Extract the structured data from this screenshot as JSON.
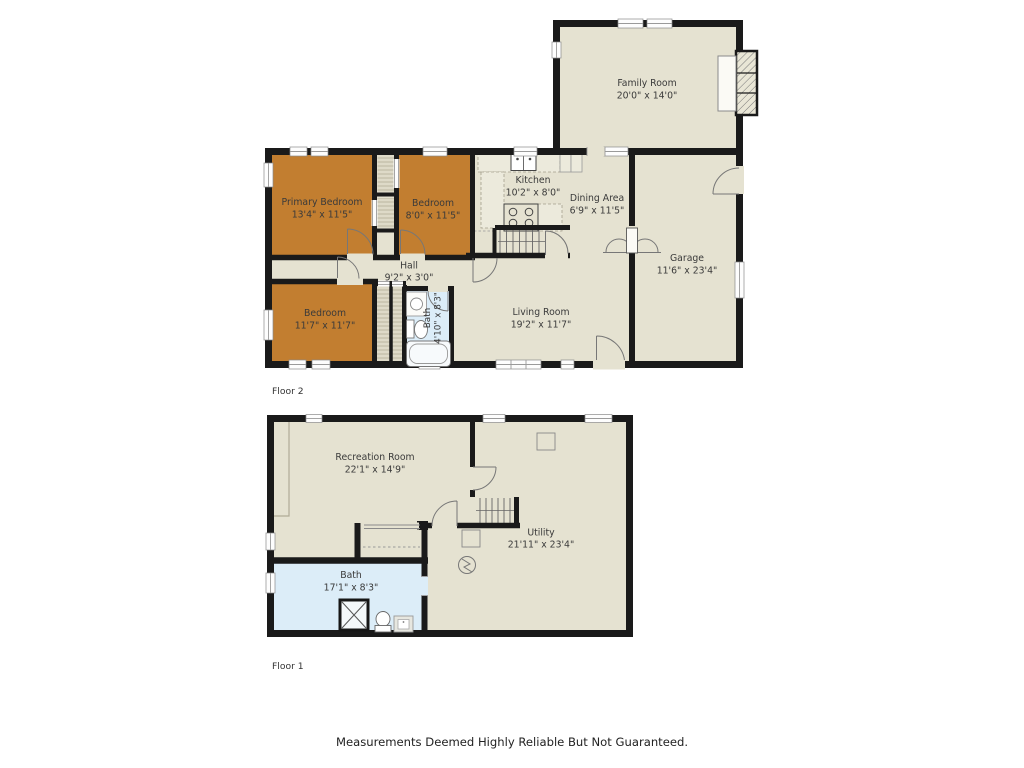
{
  "page": {
    "disclaimer": "Measurements Deemed Highly Reliable But Not Guaranteed."
  },
  "colors": {
    "floor_fill": "#E5E2D1",
    "bedroom_accent": "#C27E30",
    "bath_fill": "#DCEDF8",
    "wall": "#1A1A1A",
    "label_text": "#3A3A3A"
  },
  "floor2": {
    "label": "Floor 2",
    "rooms": {
      "family_room": {
        "name": "Family Room",
        "dims": "20'0\" x 14'0\""
      },
      "kitchen": {
        "name": "Kitchen",
        "dims": "10'2\" x 8'0\""
      },
      "dining": {
        "name": "Dining Area",
        "dims": "6'9\" x 11'5\""
      },
      "primary_bedroom": {
        "name": "Primary Bedroom",
        "dims": "13'4\" x 11'5\""
      },
      "bedroom2": {
        "name": "Bedroom",
        "dims": "8'0\" x 11'5\""
      },
      "bedroom3": {
        "name": "Bedroom",
        "dims": "11'7\" x 11'7\""
      },
      "hall": {
        "name": "Hall",
        "dims": "9'2\" x 3'0\""
      },
      "bath": {
        "name": "Bath",
        "dims": "4'10\" x 8'3\""
      },
      "living": {
        "name": "Living Room",
        "dims": "19'2\" x 11'7\""
      },
      "garage": {
        "name": "Garage",
        "dims": "11'6\" x 23'4\""
      }
    }
  },
  "floor1": {
    "label": "Floor 1",
    "rooms": {
      "recreation": {
        "name": "Recreation Room",
        "dims": "22'1\" x 14'9\""
      },
      "utility": {
        "name": "Utility",
        "dims": "21'11\" x 23'4\""
      },
      "bath": {
        "name": "Bath",
        "dims": "17'1\" x 8'3\""
      }
    }
  }
}
